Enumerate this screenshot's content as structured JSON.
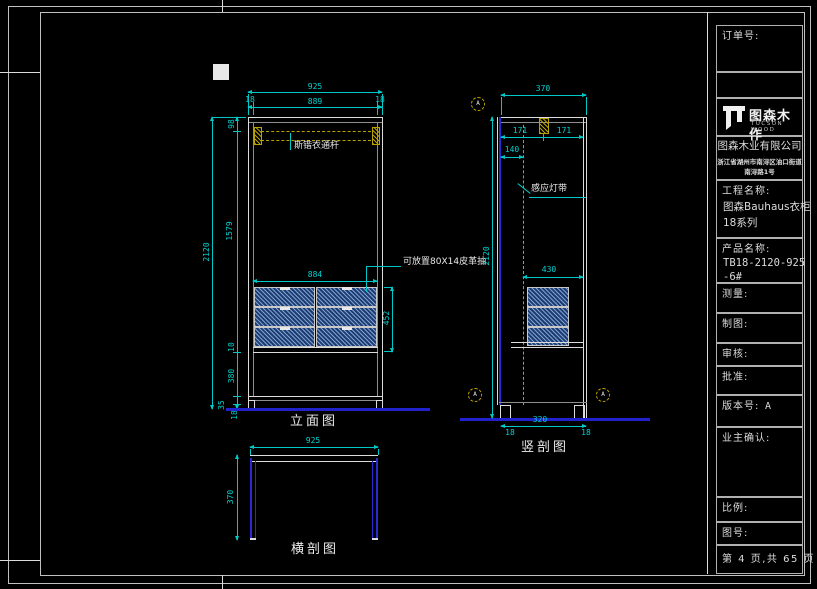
{
  "titleblock": {
    "order_label": "订单号:",
    "logo_name": "图森木作",
    "logo_sub": "TUCSON WOOD",
    "company": "图森木业有限公司",
    "address_line1": "浙江省湖州市南浔区油口街道",
    "address_line2": "南浔路1号",
    "project_label": "工程名称:",
    "project_line1": "图森Bauhaus衣柜",
    "project_line2": "18系列",
    "product_label": "产品名称:",
    "product_line1": "TB18-2120-925",
    "product_line2": "-6#",
    "measure_label": "测量:",
    "draft_label": "制图:",
    "review_label": "审核:",
    "approve_label": "批准:",
    "version_label": "版本号:",
    "version_value": "A",
    "owner_confirm_label": "业主确认:",
    "scale_label": "比例:",
    "drawing_no_label": "图号:",
    "page_text": "第 4 页,共 65 页"
  },
  "views": {
    "front": {
      "title": "立面图",
      "rod_label": "斯锴衣通杆",
      "drawer_note": "可放置80X14皮革抽",
      "dims": {
        "total_width": "925",
        "side_left": "18",
        "inner_width": "889",
        "side_right": "18",
        "total_height": "2120",
        "top_seg": "98",
        "mid_seg": "1579",
        "gap_seg": "10",
        "lower_seg": "380",
        "leg_seg": "35",
        "base_seg": "18",
        "drawer_width": "884",
        "drawer_height": "452"
      }
    },
    "vsection": {
      "title": "竖剖图",
      "led_label": "感应灯带",
      "callout": "A",
      "dims": {
        "depth": "370",
        "front_seg": "171",
        "back_seg": "171",
        "led_offset": "140",
        "drawer_depth": "430",
        "total_height": "2120",
        "bottom_span": "320",
        "bottom_left": "18",
        "bottom_right": "18"
      }
    },
    "hsection": {
      "title": "横剖图",
      "dims": {
        "width": "925",
        "depth": "370"
      }
    }
  }
}
